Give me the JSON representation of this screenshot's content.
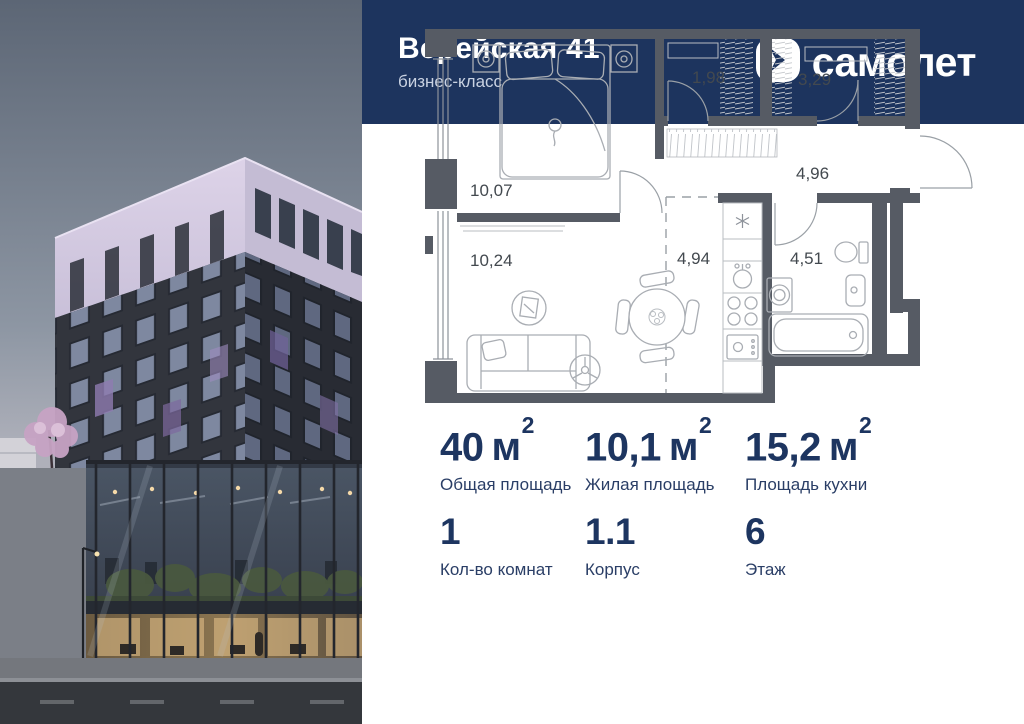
{
  "header": {
    "title": "Верейская 41",
    "subtitle": "бизнес-класс",
    "brand": "самолет"
  },
  "plan": {
    "rooms": [
      {
        "name": "bedroom",
        "area": "10,07"
      },
      {
        "name": "wardrobe-small",
        "area": "1,98"
      },
      {
        "name": "wardrobe-large",
        "area": "3,29"
      },
      {
        "name": "hallway",
        "area": "4,96"
      },
      {
        "name": "living-room",
        "area": "10,24"
      },
      {
        "name": "kitchen-dining",
        "area": "4,94"
      },
      {
        "name": "bathroom",
        "area": "4,51"
      }
    ]
  },
  "stats": {
    "items": [
      {
        "num": "40",
        "unit": "м",
        "sup": "2",
        "label": "Общая площадь"
      },
      {
        "num": "10,1",
        "unit": "м",
        "sup": "2",
        "label": "Жилая площадь"
      },
      {
        "num": "15,2",
        "unit": "м",
        "sup": "2",
        "label": "Площадь кухни"
      },
      {
        "num": "1",
        "label": "Кол-во комнат"
      },
      {
        "num": "1.1",
        "label": "Корпус"
      },
      {
        "num": "6",
        "label": "Этаж"
      }
    ]
  },
  "colors": {
    "page-bg": "#ffffff",
    "header-bg": "#1d345e",
    "header-title": "#ffffff",
    "header-subtitle": "#c9d2e2",
    "accent-navy": "#1d3560",
    "stat-label": "#2a3e66",
    "plan-wall": "#565b64",
    "plan-furniture": "#a9adb3",
    "plan-hatch": "#c6c9cd",
    "plan-label": "#43494f",
    "photo-lavender": "#cfc6de",
    "photo-facade": "#32353d",
    "photo-glass-warm": "#8a744f"
  }
}
